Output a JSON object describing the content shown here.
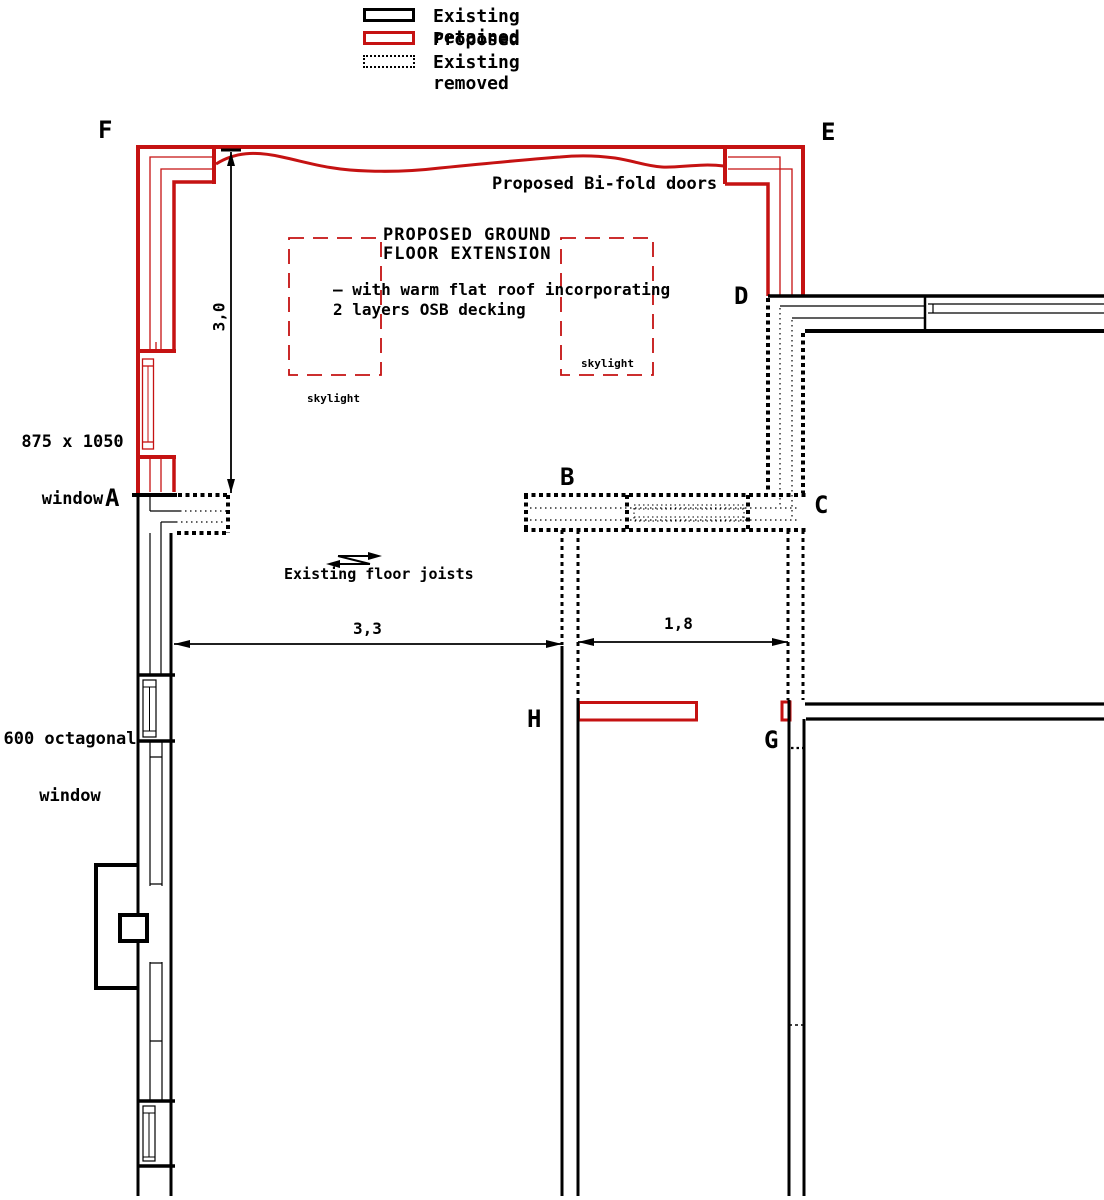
{
  "legend": {
    "items": [
      {
        "label": "Existing retained",
        "type": "existing-retained"
      },
      {
        "label": "Proposed",
        "type": "proposed"
      },
      {
        "label": "Existing removed",
        "type": "existing-removed"
      }
    ]
  },
  "point_labels": {
    "A": "A",
    "B": "B",
    "C": "C",
    "D": "D",
    "E": "E",
    "F": "F",
    "G": "G",
    "H": "H"
  },
  "annotations": {
    "bifold_doors": "Proposed Bi-fold doors",
    "extension_title_line1": "PROPOSED GROUND",
    "extension_title_line2": "FLOOR EXTENSION",
    "roof_note_line1": "– with warm flat roof incorporating",
    "roof_note_line2": "2 layers OSB decking",
    "skylight_left": "skylight",
    "skylight_right": "skylight",
    "window_875_line1": "875 x 1050",
    "window_875_line2": "window",
    "window_600_line1": "600 octagonal",
    "window_600_line2": "window",
    "floor_joists": "Existing floor joists"
  },
  "dimensions": {
    "extension_depth": "3,0",
    "opening_width_left": "3,3",
    "opening_width_right": "1,8"
  },
  "colors": {
    "proposed_red": "#c51212",
    "existing_black": "#000000",
    "background": "#ffffff"
  }
}
